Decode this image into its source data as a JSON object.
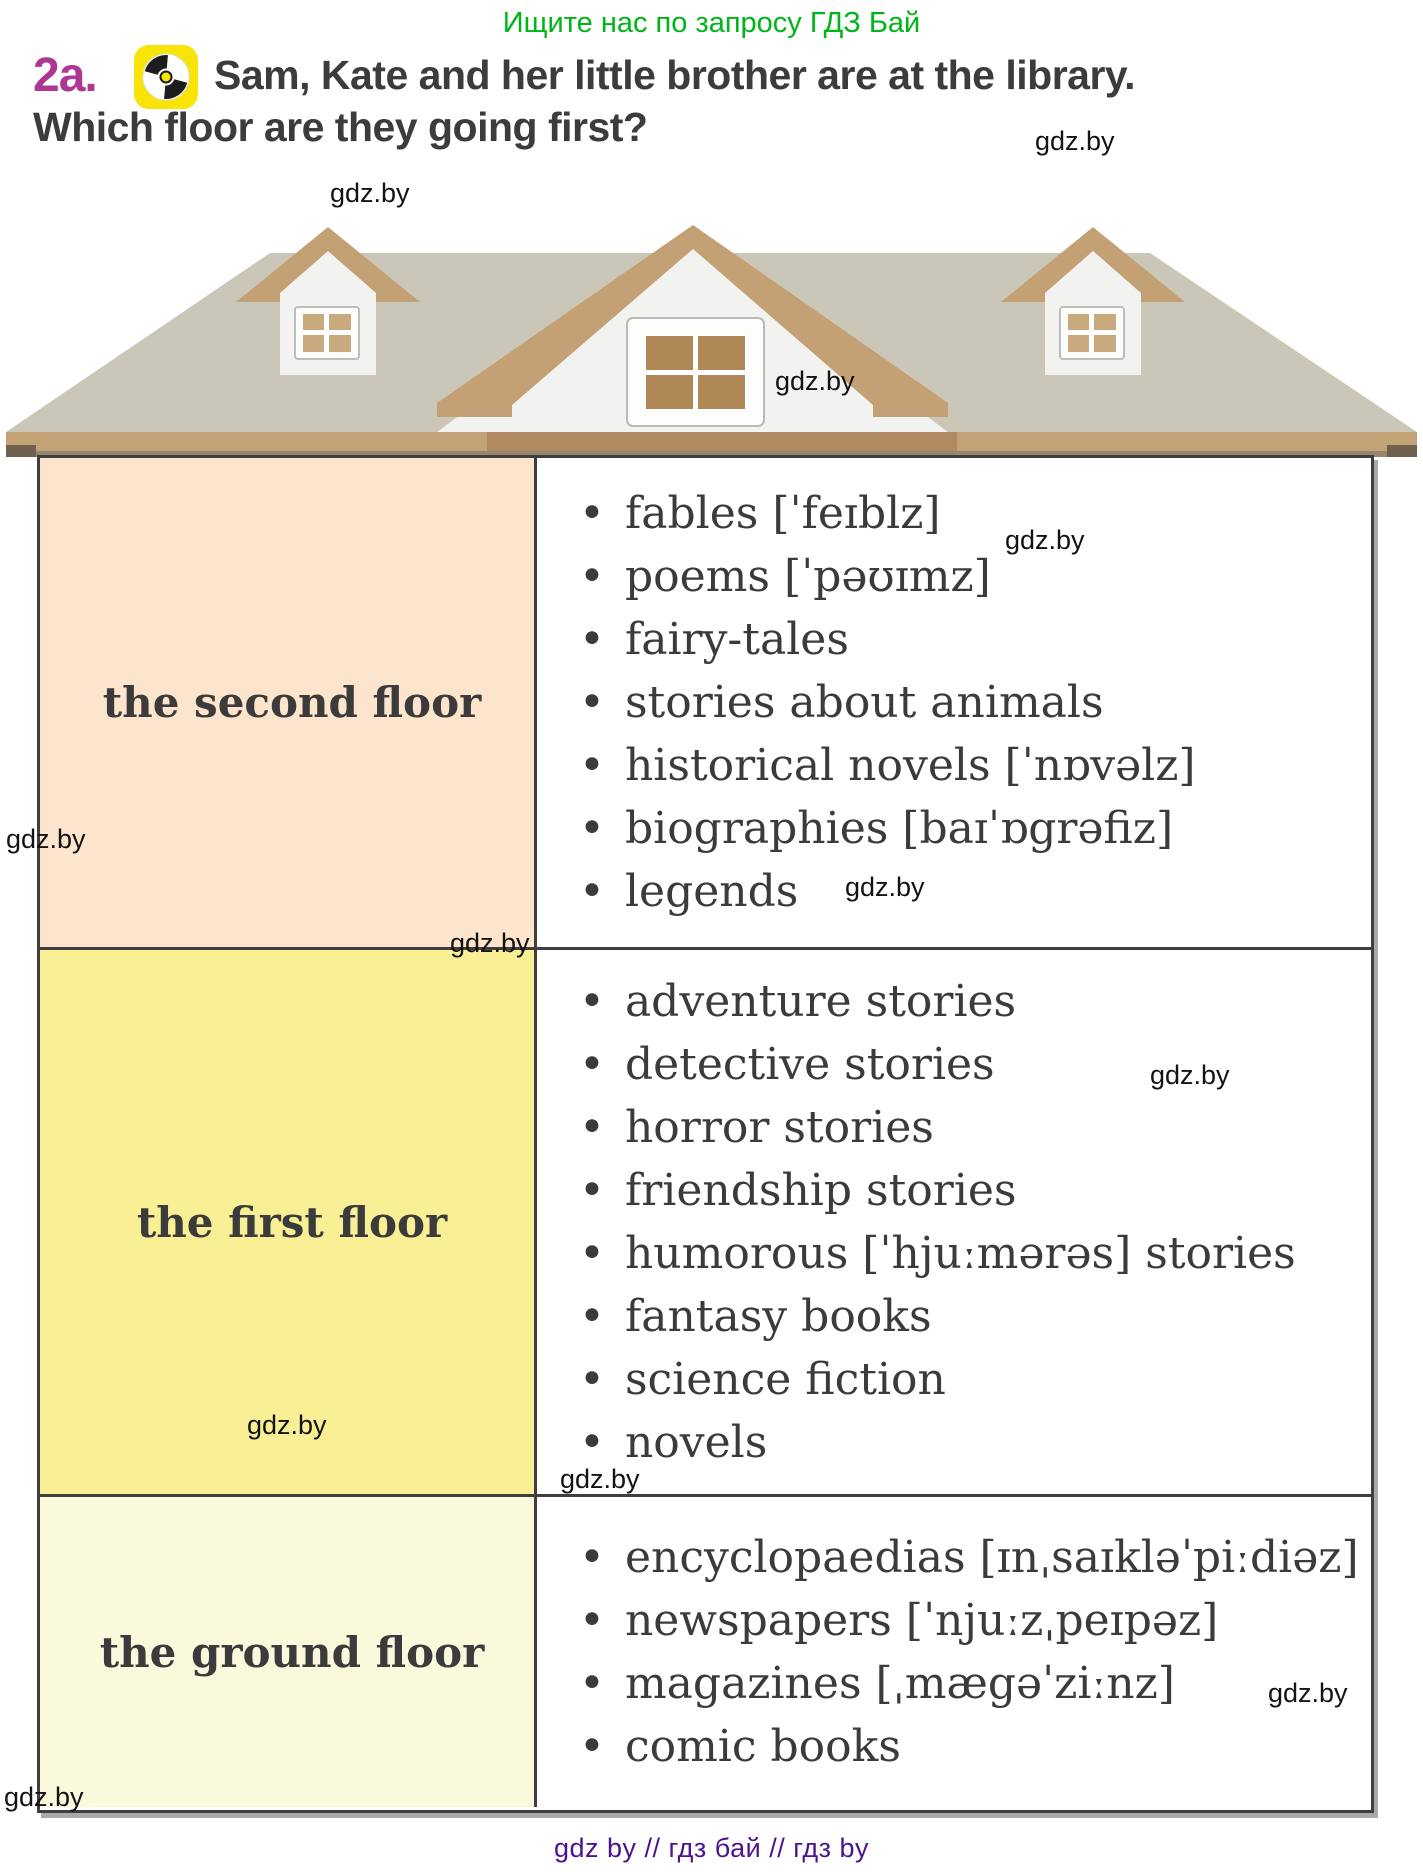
{
  "promo_top": "Ищите нас по запросу ГДЗ Бай",
  "exercise": {
    "number": "2a.",
    "icon": "cd-audio-icon",
    "title_line1": "Sam, Kate and her little brother are at the library.",
    "title_line2": "Which floor are they going first?"
  },
  "colors": {
    "promo_green": "#00b517",
    "exercise_magenta": "#ad3893",
    "cd_badge_yellow": "#f8e408",
    "text_dark": "#3c3c3c",
    "second_floor_bg": "#fce5cc",
    "first_floor_bg": "#f9f095",
    "ground_floor_bg": "#fbf9dc",
    "table_border": "#3f3f3f",
    "roof_gray": "#cac7b9",
    "trim_tan": "#c3a174",
    "footer_purple": "#4c1390"
  },
  "library_floors": [
    {
      "label": "the second floor",
      "bg": "#fce5cc",
      "items": [
        "fables [ˈfeɪblz]",
        "poems [ˈpəʊɪmz]",
        "fairy-tales",
        "stories about animals",
        "historical novels [ˈnɒvəlz]",
        "biographies [baɪˈɒgrəfiz]",
        "legends"
      ]
    },
    {
      "label": "the first floor",
      "bg": "#f9f095",
      "items": [
        "adventure stories",
        "detective stories",
        "horror stories",
        "friendship stories",
        "humorous [ˈhjuːmərəs] stories",
        "fantasy books",
        "science fiction",
        "novels"
      ]
    },
    {
      "label": "the ground floor",
      "bg": "#fbf9dc",
      "items": [
        "encyclopaedias [ɪnˌsaɪkləˈpiːdiəz]",
        "newspapers [ˈnjuːzˌpeɪpəz]",
        "magazines [ˌmægəˈziːnz]",
        "comic books"
      ]
    }
  ],
  "watermark": {
    "text": "gdz.by"
  },
  "footer": {
    "text": "gdz by  //  гдз бай  //  гдз by"
  }
}
